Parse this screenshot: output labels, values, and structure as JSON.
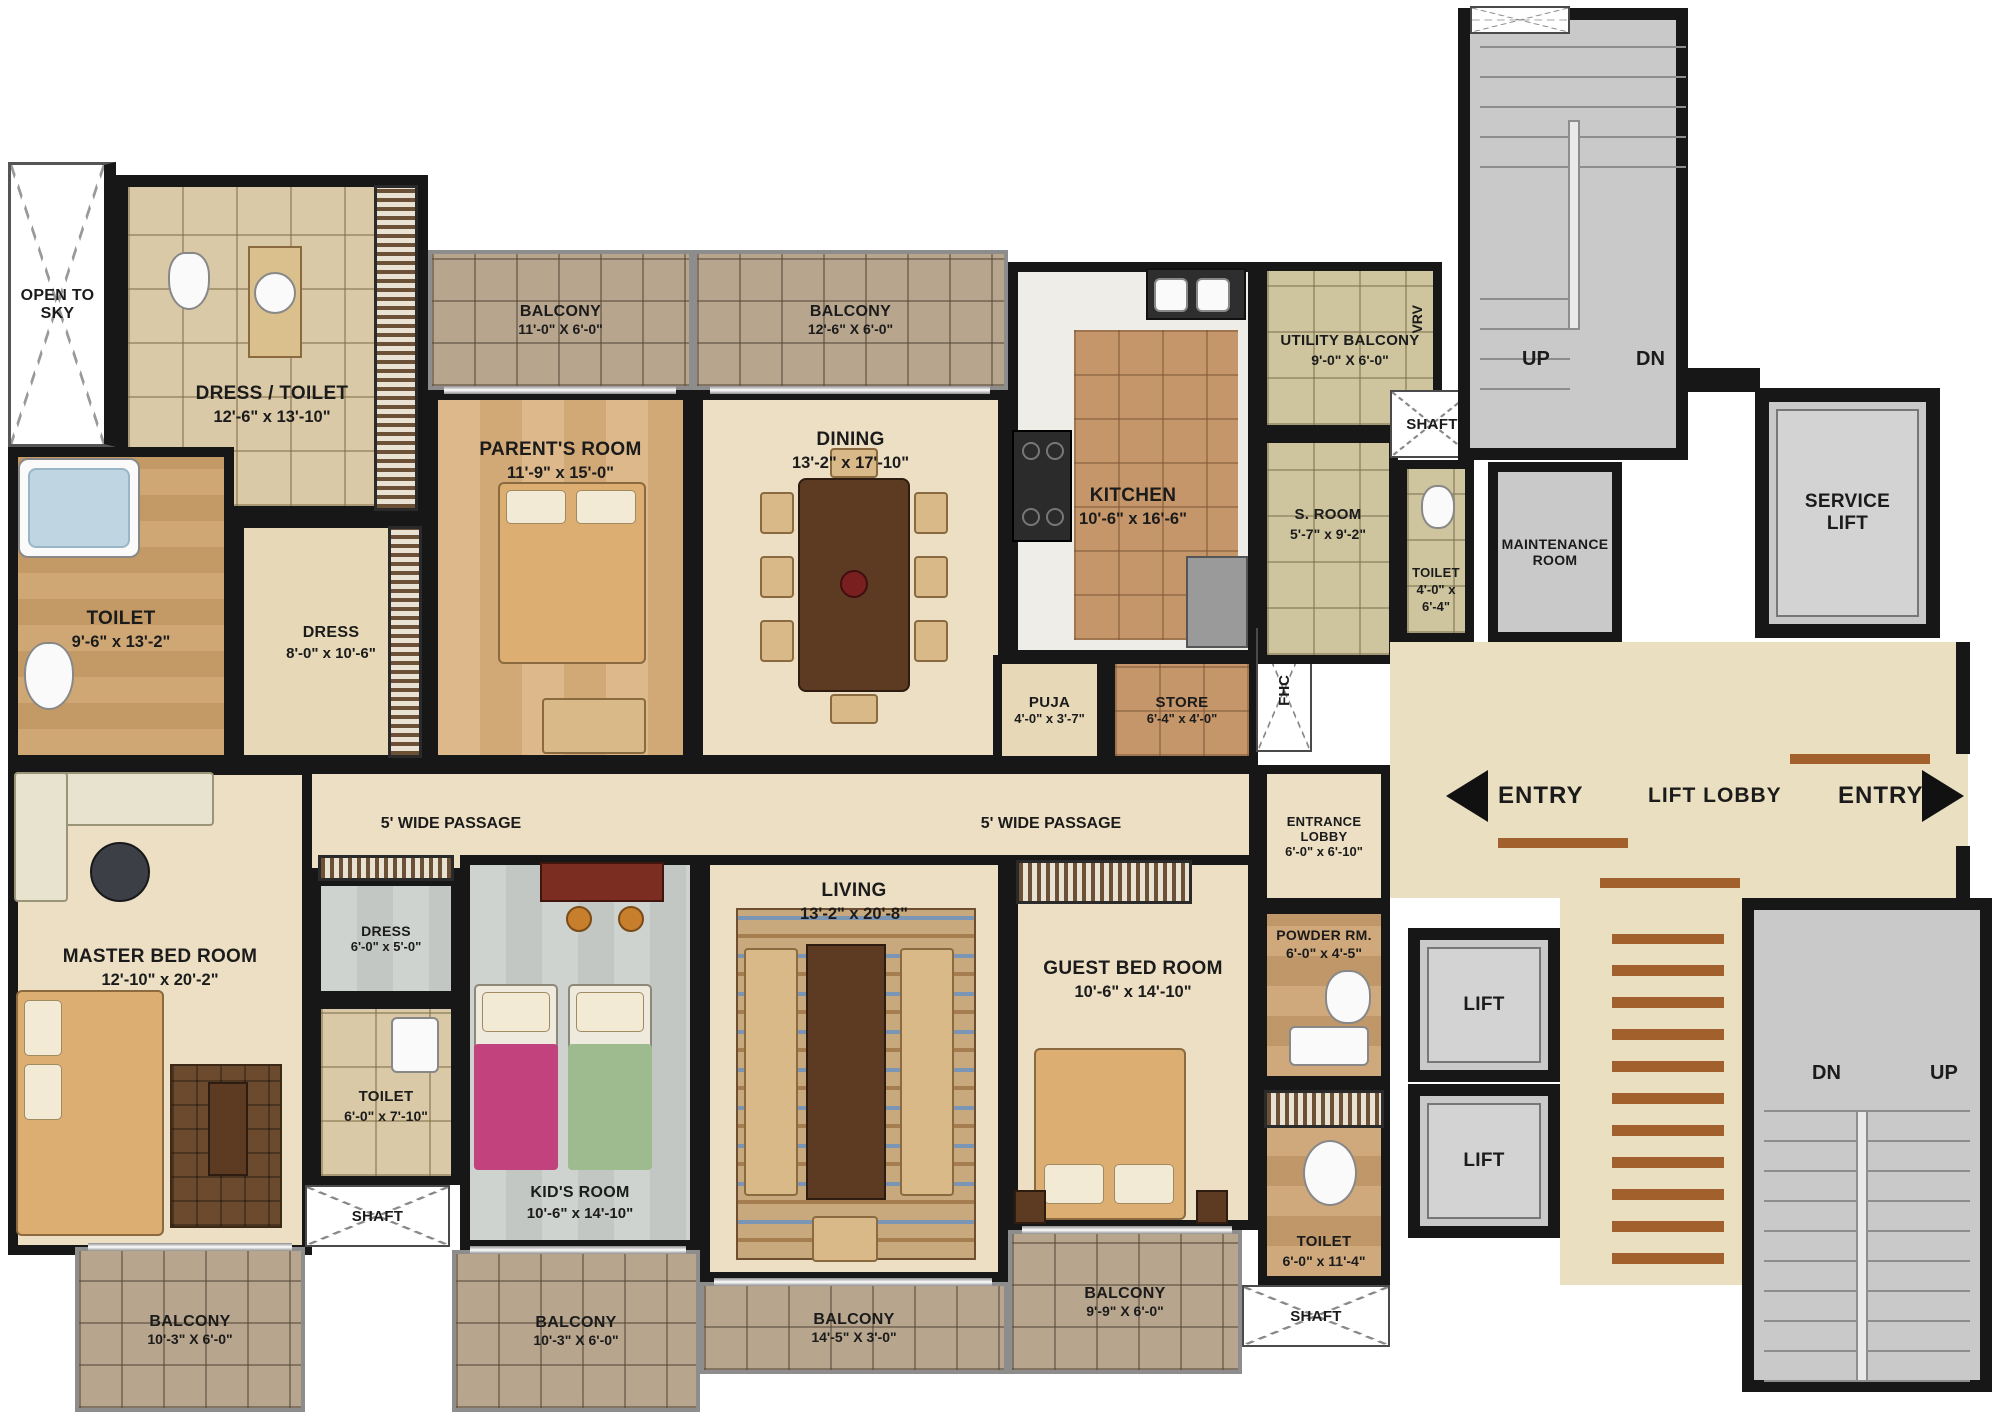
{
  "palette": {
    "wall": "#171717",
    "marble_floor": "#ecdfc3",
    "wood_floor": "#d5ae7d",
    "balcony_tile": "#b7a58d",
    "khaki_tile": "#cec59f",
    "kitchen_tile": "#c59669",
    "gray_core": "#c9c9c9",
    "accent_strip": "#a2602c"
  },
  "rooms": {
    "open_to_sky": {
      "label": "OPEN TO SKY"
    },
    "dress_toilet": {
      "label": "DRESS / TOILET",
      "dims": "12'-6\" x 13'-10\""
    },
    "toilet_big": {
      "label": "TOILET",
      "dims": "9'-6\" x 13'-2\""
    },
    "dress_parents": {
      "label": "DRESS",
      "dims": "8'-0\" x 10'-6\""
    },
    "parents_room": {
      "label": "PARENT'S ROOM",
      "dims": "11'-9\" x 15'-0\""
    },
    "balcony_parents": {
      "label": "BALCONY",
      "dims": "11'-0\" X 6'-0\""
    },
    "balcony_dining": {
      "label": "BALCONY",
      "dims": "12'-6\" X 6'-0\""
    },
    "dining": {
      "label": "DINING",
      "dims": "13'-2\" x 17'-10\""
    },
    "kitchen": {
      "label": "KITCHEN",
      "dims": "10'-6\" x 16'-6\""
    },
    "puja": {
      "label": "PUJA",
      "dims": "4'-0\" x 3'-7\""
    },
    "store": {
      "label": "STORE",
      "dims": "6'-4\" x 4'-0\""
    },
    "fhc": {
      "label": "FHC"
    },
    "utility_balcony": {
      "label": "UTILITY BALCONY",
      "dims": "9'-0\" X 6'-0\""
    },
    "vrv": {
      "label": "VRV"
    },
    "s_room": {
      "label": "S. ROOM",
      "dims": "5'-7\" x 9'-2\""
    },
    "toilet_s": {
      "label": "TOILET",
      "dims": "4'-0\" x 6'-4\""
    },
    "shaft_top": {
      "label": "SHAFT"
    },
    "maintenance": {
      "label": "MAINTENANCE ROOM"
    },
    "stairs_top": {
      "up": "UP",
      "dn": "DN"
    },
    "service_lift": {
      "label": "SERVICE LIFT"
    },
    "passage": {
      "label": "5'  WIDE PASSAGE"
    },
    "entrance_lobby": {
      "label": "ENTRANCE LOBBY",
      "dims": "6'-0\" x 6'-10\""
    },
    "entry_left": {
      "label": "ENTRY"
    },
    "lift_lobby": {
      "label": "LIFT LOBBY"
    },
    "entry_right": {
      "label": "ENTRY"
    },
    "master_bed": {
      "label": "MASTER BED ROOM",
      "dims": "12'-10\" x 20'-2\""
    },
    "dress_master": {
      "label": "DRESS",
      "dims": "6'-0\" x 5'-0\""
    },
    "toilet_master": {
      "label": "TOILET",
      "dims": "6'-0\" x 7'-10\""
    },
    "shaft_bl": {
      "label": "SHAFT"
    },
    "kids_room": {
      "label": "KID'S ROOM",
      "dims": "10'-6\" x 14'-10\""
    },
    "living": {
      "label": "LIVING",
      "dims": "13'-2\" x 20'-8\""
    },
    "guest_bed": {
      "label": "GUEST BED ROOM",
      "dims": "10'-6\" x 14'-10\""
    },
    "powder": {
      "label": "POWDER RM.",
      "dims": "6'-0\" x 4'-5\""
    },
    "toilet_guest": {
      "label": "TOILET",
      "dims": "6'-0\" x 11'-4\""
    },
    "shaft_br": {
      "label": "SHAFT"
    },
    "lift": {
      "label": "LIFT"
    },
    "balcony_master": {
      "label": "BALCONY",
      "dims": "10'-3\" X 6'-0\""
    },
    "balcony_kids": {
      "label": "BALCONY",
      "dims": "10'-3\" X 6'-0\""
    },
    "balcony_living": {
      "label": "BALCONY",
      "dims": "14'-5\" X 3'-0\""
    },
    "balcony_guest": {
      "label": "BALCONY",
      "dims": "9'-9\" X 6'-0\""
    },
    "stairs_bottom": {
      "dn": "DN",
      "up": "UP"
    }
  }
}
